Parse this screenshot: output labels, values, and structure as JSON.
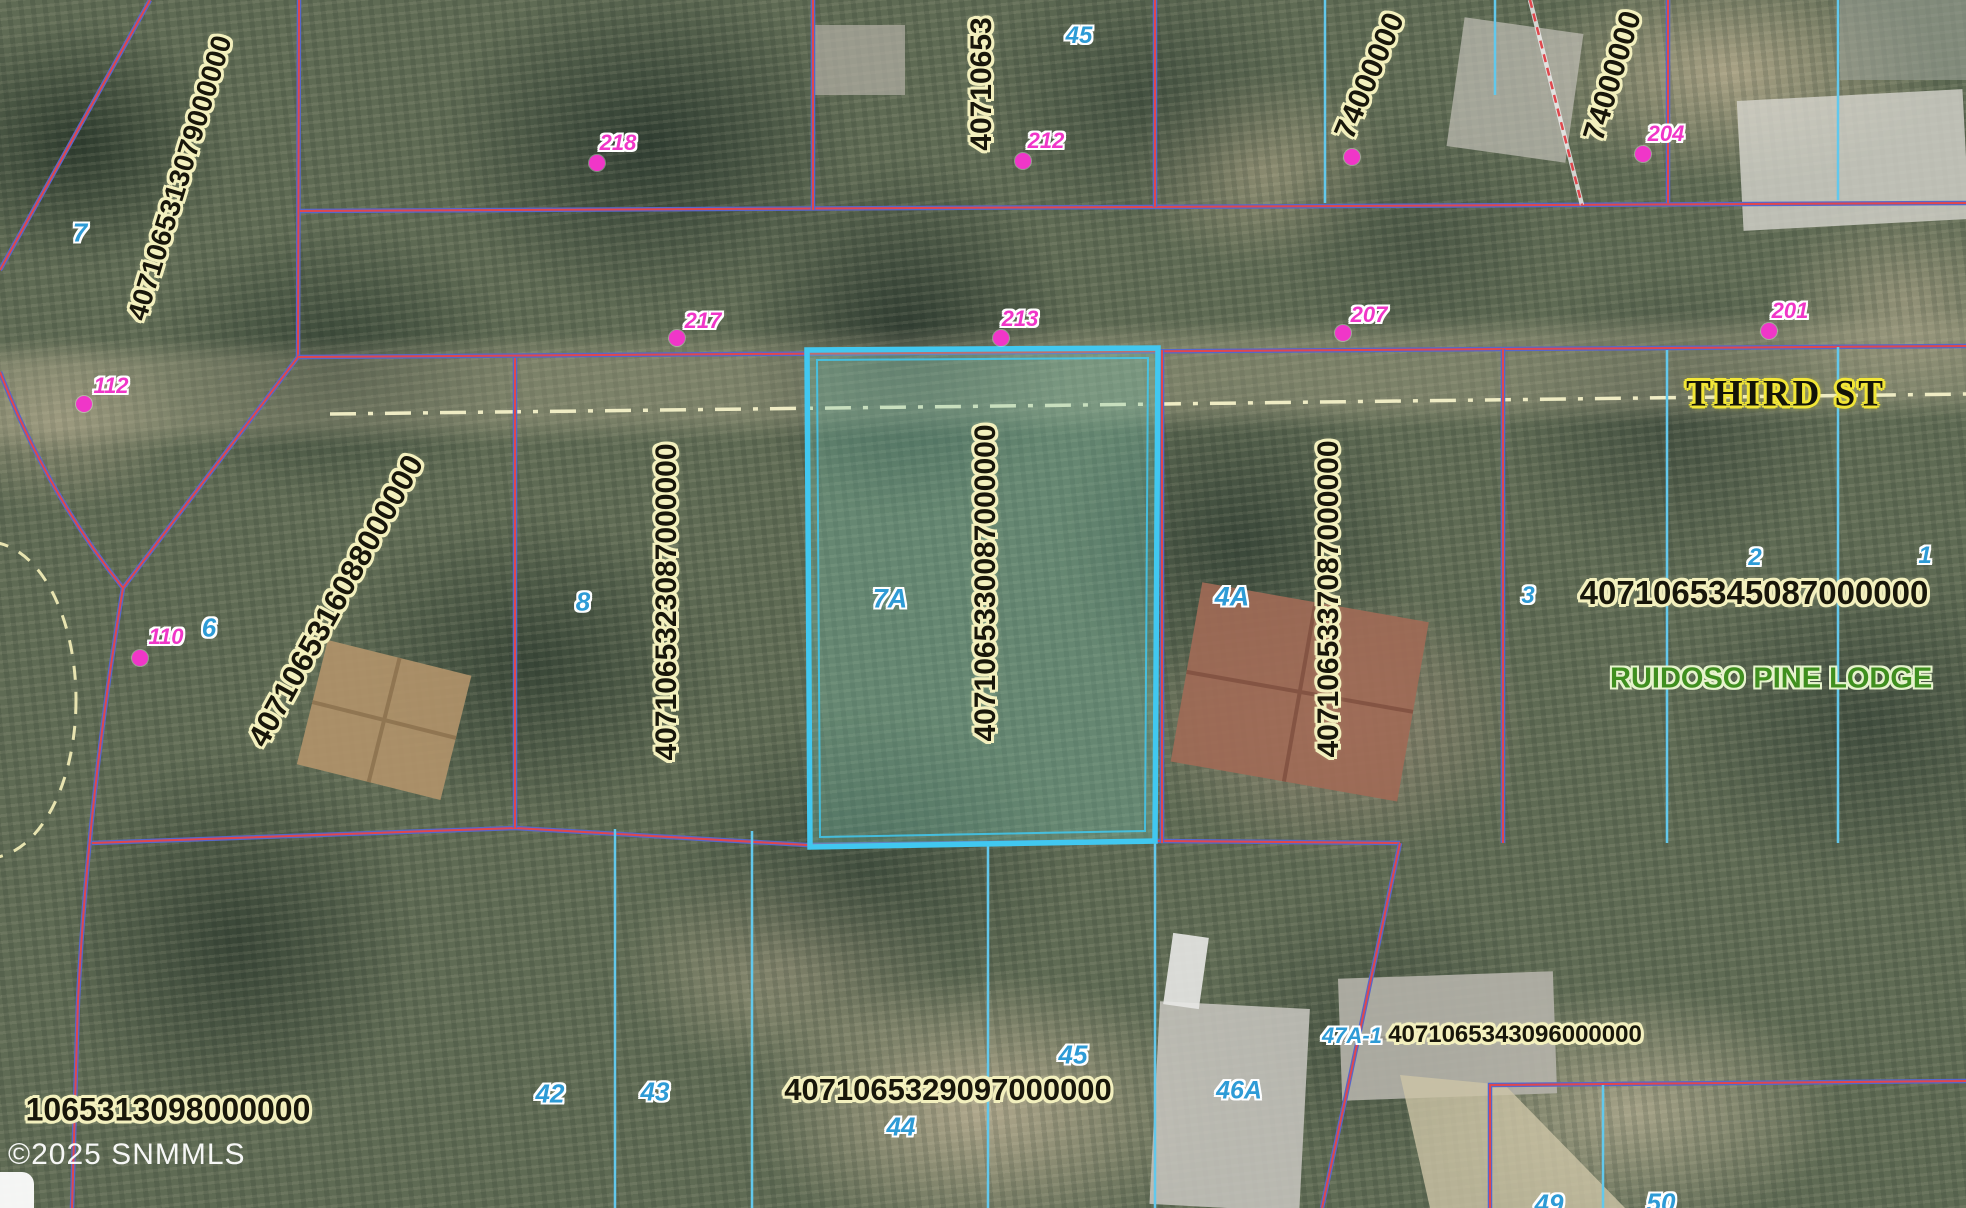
{
  "map": {
    "copyright": "©2025 SNMMLS",
    "street": {
      "label": "THIRD ST",
      "x": 1786,
      "y": 394
    },
    "subdivision": {
      "label": "RUIDOSO PINE LODGE",
      "x": 1610,
      "y": 679
    },
    "highlight": {
      "lot": "7A",
      "parcel_id": "4071065330087000000"
    },
    "colors": {
      "parcel_line_red": "#e0474d",
      "parcel_line_blue": "#5767c9",
      "lot_line_cyan": "#62c8ec",
      "highlight_cyan": "#41c8f0",
      "parcel_label_halo": "#f3f0be",
      "address_magenta": "#f036c8",
      "lot_number_blue": "#2e9bd6",
      "street_halo_yellow": "#f2e636",
      "subdivision_green": "#3f8f1f",
      "centerline_cream": "#efecc4"
    },
    "parcel_labels": [
      {
        "id": "4071065313079000000",
        "x": 180,
        "y": 178,
        "rot": -73,
        "size": 28
      },
      {
        "id": "4071065316088000000",
        "x": 336,
        "y": 601,
        "rot": -61,
        "size": 31
      },
      {
        "id": "4071065323087000000",
        "x": 667,
        "y": 602,
        "rot": -90,
        "size": 30
      },
      {
        "id": "4071065330087000000",
        "x": 986,
        "y": 583,
        "rot": -90,
        "size": 30
      },
      {
        "id": "4071065337087000000",
        "x": 1329,
        "y": 599,
        "rot": -90,
        "size": 30
      },
      {
        "id": "40710653",
        "x": 982,
        "y": 84,
        "rot": -90,
        "size": 30
      },
      {
        "id": "74000000",
        "x": 1370,
        "y": 76,
        "rot": -67,
        "size": 30
      },
      {
        "id": "74000000",
        "x": 1613,
        "y": 76,
        "rot": -73,
        "size": 30
      },
      {
        "id": "4071065329097000000",
        "x": 948,
        "y": 1090,
        "rot": 0,
        "size": 31
      },
      {
        "id": "4071065343096000000",
        "x": 1515,
        "y": 1035,
        "rot": 0,
        "size": 24
      },
      {
        "id": "4071065345087000000",
        "x": 1754,
        "y": 593,
        "rot": 0,
        "size": 33
      },
      {
        "id": "1065313098000000",
        "x": 168,
        "y": 1110,
        "rot": 0,
        "size": 32
      }
    ],
    "lot_labels": [
      {
        "n": "7",
        "x": 80,
        "y": 233,
        "size": 26
      },
      {
        "n": "45",
        "x": 1079,
        "y": 36,
        "size": 24
      },
      {
        "n": "6",
        "x": 209,
        "y": 628,
        "size": 26
      },
      {
        "n": "8",
        "x": 583,
        "y": 602,
        "size": 26
      },
      {
        "n": "7A",
        "x": 890,
        "y": 599,
        "size": 27
      },
      {
        "n": "4A",
        "x": 1232,
        "y": 597,
        "size": 27
      },
      {
        "n": "3",
        "x": 1528,
        "y": 596,
        "size": 24
      },
      {
        "n": "2",
        "x": 1755,
        "y": 558,
        "size": 24
      },
      {
        "n": "1",
        "x": 1925,
        "y": 556,
        "size": 24
      },
      {
        "n": "42",
        "x": 550,
        "y": 1094,
        "size": 26
      },
      {
        "n": "43",
        "x": 655,
        "y": 1092,
        "size": 26
      },
      {
        "n": "44",
        "x": 901,
        "y": 1127,
        "size": 26
      },
      {
        "n": "45",
        "x": 1073,
        "y": 1055,
        "size": 26
      },
      {
        "n": "46A",
        "x": 1239,
        "y": 1091,
        "size": 25
      },
      {
        "n": "47A-1",
        "x": 1352,
        "y": 1036,
        "size": 22
      },
      {
        "n": "49",
        "x": 1549,
        "y": 1204,
        "size": 26
      },
      {
        "n": "50",
        "x": 1661,
        "y": 1203,
        "size": 26
      }
    ],
    "addresses": [
      {
        "number": "218",
        "x": 618,
        "y": 143,
        "dot": {
          "x": 597,
          "y": 163
        }
      },
      {
        "number": "212",
        "x": 1046,
        "y": 141,
        "dot": {
          "x": 1023,
          "y": 161
        }
      },
      {
        "number": "204",
        "x": 1666,
        "y": 134,
        "dot": {
          "x": 1643,
          "y": 154
        }
      },
      {
        "number": "",
        "x": 1360,
        "y": 140,
        "dot": {
          "x": 1352,
          "y": 157
        }
      },
      {
        "number": "217",
        "x": 703,
        "y": 321,
        "dot": {
          "x": 677,
          "y": 338
        }
      },
      {
        "number": "213",
        "x": 1020,
        "y": 319,
        "dot": {
          "x": 1001,
          "y": 338
        }
      },
      {
        "number": "207",
        "x": 1369,
        "y": 315,
        "dot": {
          "x": 1343,
          "y": 333
        }
      },
      {
        "number": "201",
        "x": 1790,
        "y": 311,
        "dot": {
          "x": 1769,
          "y": 331
        }
      },
      {
        "number": "112",
        "x": 111,
        "y": 386,
        "dot": {
          "x": 84,
          "y": 404
        }
      },
      {
        "number": "110",
        "x": 166,
        "y": 637,
        "dot": {
          "x": 140,
          "y": 658
        }
      }
    ]
  }
}
